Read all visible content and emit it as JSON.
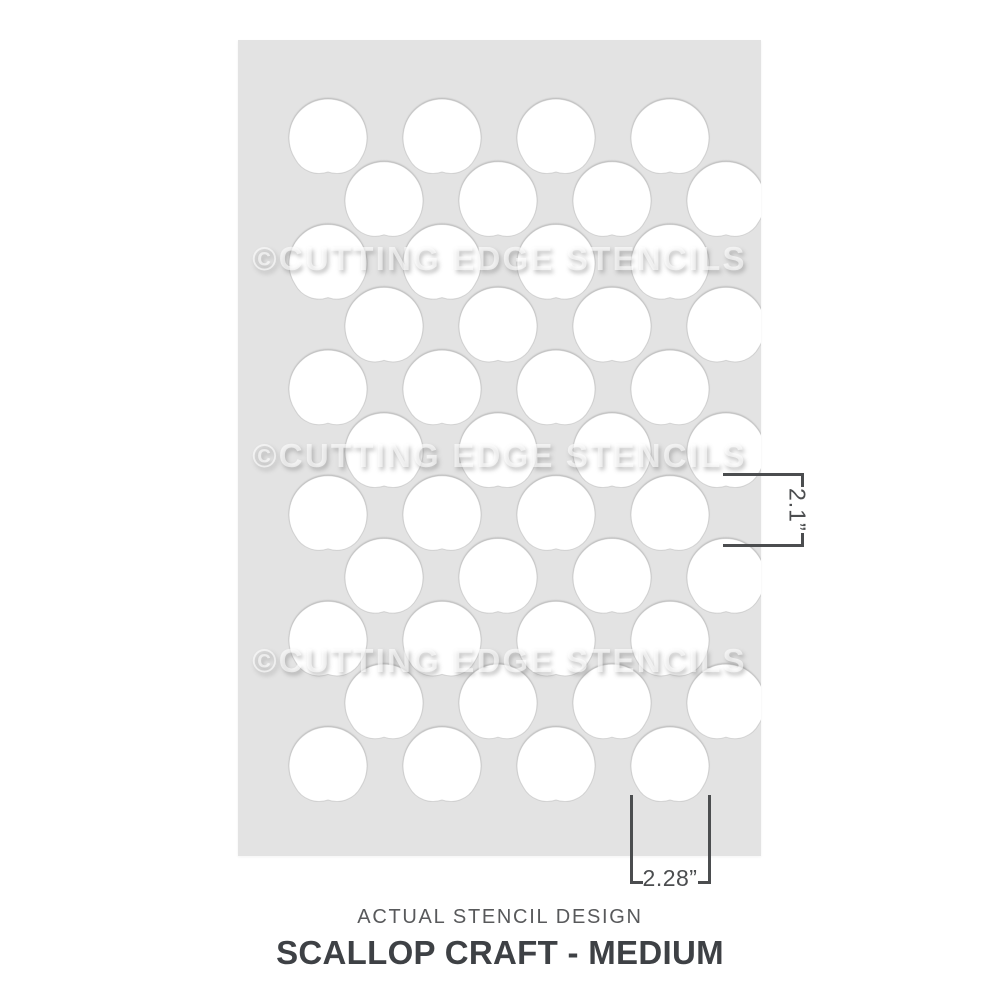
{
  "page": {
    "background": "#ffffff"
  },
  "stencil": {
    "watermark_text": "©CUTTING EDGE STENCILS",
    "sheet_color": "#e3e3e3",
    "cutout_color": "#ffffff",
    "pattern": {
      "type": "scallop-fish-scale",
      "rows": 11,
      "scallops_per_row": 4,
      "scallop_width_px": 78,
      "scallop_height_px": 73,
      "circle_radius_px": 39,
      "col_pitch_px": 114,
      "row_pitch_px": 62.8,
      "row_a_first_center_x": 90,
      "row_b_first_center_x": 146,
      "first_row_top_y": 59
    }
  },
  "dimensions": {
    "height_label": "2.1”",
    "width_label": "2.28”",
    "line_color": "#4b4d4f",
    "unit": "inches"
  },
  "footer": {
    "caption": "ACTUAL STENCIL DESIGN",
    "title": "SCALLOP CRAFT - MEDIUM"
  }
}
